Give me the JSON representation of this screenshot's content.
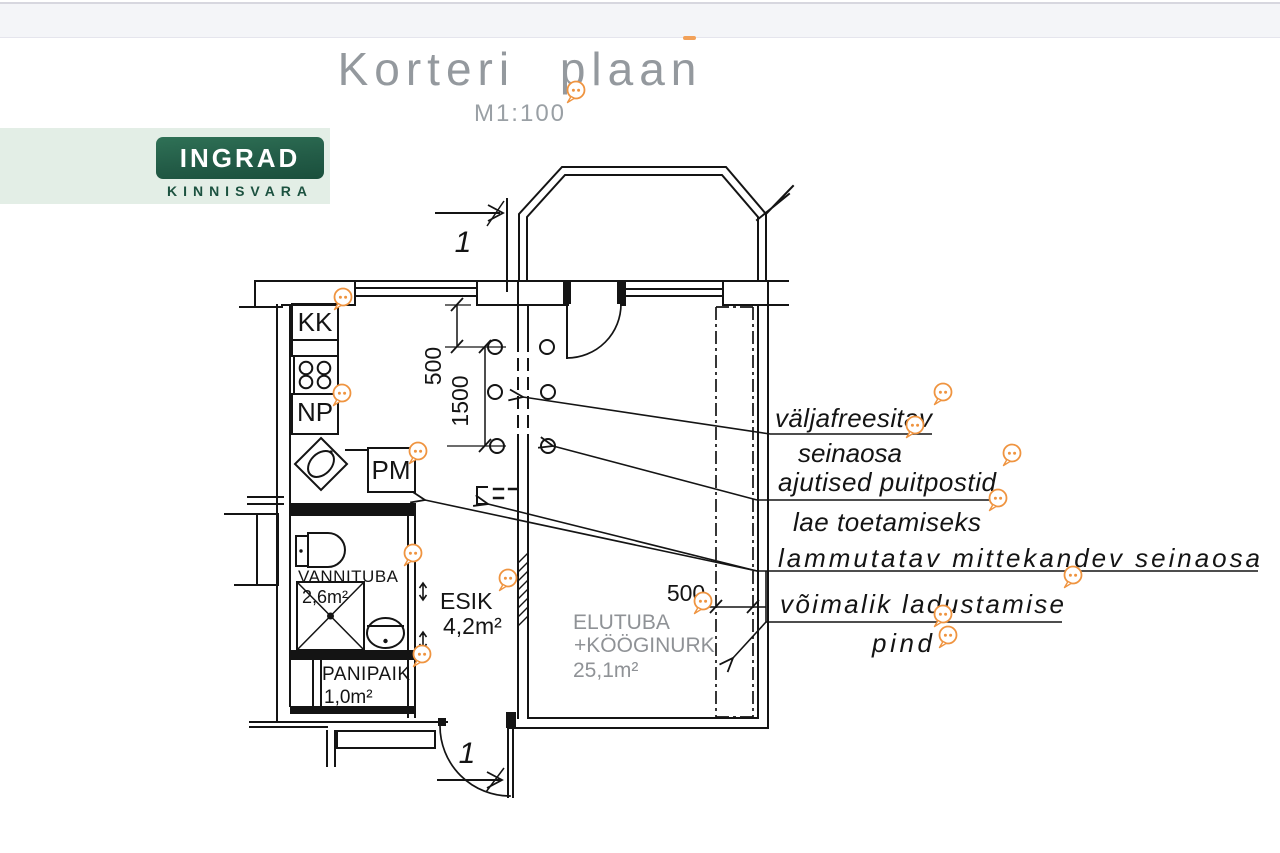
{
  "header": {
    "title": "Korteri plaan",
    "scale": "M1:100"
  },
  "logo": {
    "brand": "INGRAD",
    "tagline": "KINNISVARA"
  },
  "plan": {
    "fixtures": {
      "kk": "KK",
      "np": "NP",
      "pm": "PM"
    },
    "rooms": {
      "vannituba": {
        "name": "VANNITUBA",
        "area": "2,6m²"
      },
      "esik": {
        "name": "ESIK",
        "area": "4,2m²"
      },
      "panipaik": {
        "name": "PANIPAIK",
        "area": "1,0m²"
      },
      "elutuba": {
        "name": "ELUTUBA",
        "name_line2": "+KÖÖGINURK",
        "area": "25,1m²"
      }
    },
    "dimensions": {
      "wall_to_post": "500",
      "post_span": "1500",
      "strip_width": "500"
    },
    "section_marks": {
      "top": "1",
      "bottom": "1"
    },
    "annotations": {
      "milled_line1": "väljafreesitav",
      "milled_line2": "seinaosa",
      "temp_posts": "ajutised puitpostid",
      "ceiling_support": "lae toetamiseks",
      "demolish_wall": "lammutatav mittekandev seinaosa",
      "storage_line1": "võimalik ladustamise",
      "storage_line2": "pind"
    }
  },
  "icons": {
    "comment_marker": "speech-bubble"
  },
  "colors": {
    "line": "#141414",
    "accent_marker": "#ef9440",
    "logo_green": "#235c47",
    "logo_band": "#e3eee6",
    "muted": "#8f9296"
  }
}
